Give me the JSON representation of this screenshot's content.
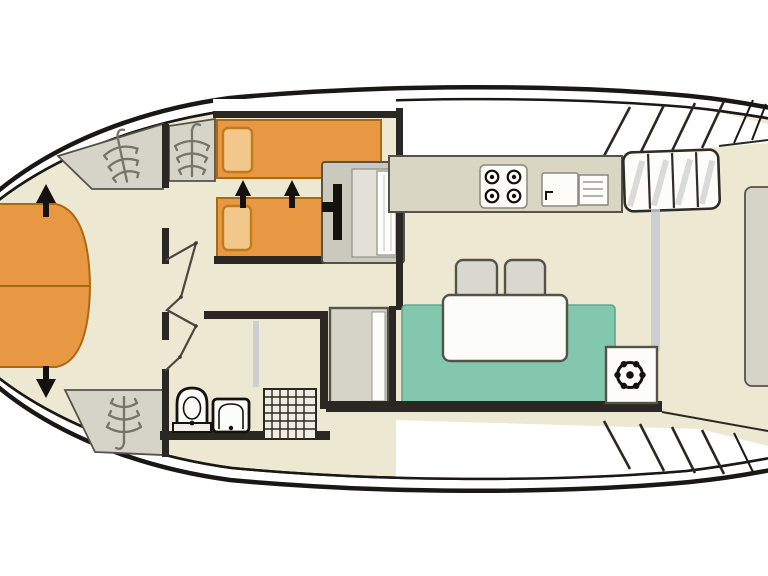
{
  "diagram": {
    "type": "yacht-floorplan-top-view",
    "colors": {
      "hull-line": "#1A1815",
      "floor": "#EDE8D1",
      "deck": "#FFFFFF",
      "wall": "#2B2722",
      "outline": "#55524A",
      "dark": "#14110E",
      "bed": "#E89743",
      "bed-border": "#AA6A12",
      "pillow": "#F2C78B",
      "pillow-border": "#C07B1B",
      "sofa": "#83C7AE",
      "sofa-border": "#5EA78E",
      "gray": "#D6D4C8",
      "counter": "#D9D6C3",
      "desk": "#CBC8BD",
      "white-item": "#FCFCF9",
      "grid": "#2B2722",
      "hanger": "#76746A",
      "accent-line": "#C4CAD0"
    },
    "icons": {
      "wardrobe": "hanger-icon",
      "stove": "stove-icon",
      "sink": "sink-icon",
      "toilet": "toilet-icon",
      "washbasin": "washbasin-icon",
      "shower": "shower-grid-icon",
      "helm": "steering-wheel-icon",
      "bed_direction": "arrow-icon"
    }
  }
}
